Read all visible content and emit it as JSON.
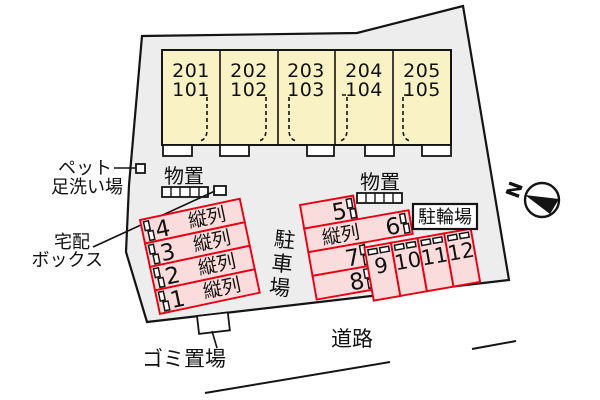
{
  "site": {
    "building": {
      "units": [
        {
          "label_top": "201",
          "label_bottom": "101"
        },
        {
          "label_top": "202",
          "label_bottom": "102"
        },
        {
          "label_top": "203",
          "label_bottom": "103"
        },
        {
          "label_top": "204",
          "label_bottom": "104"
        },
        {
          "label_top": "205",
          "label_bottom": "105"
        }
      ]
    },
    "labels": {
      "storage_left": "物置",
      "storage_right": "物置",
      "pet_wash_line1": "ペット",
      "pet_wash_line2": "足洗い場",
      "delivery_line1": "宅配",
      "delivery_line2": "ボックス",
      "garbage": "ゴミ置場",
      "road": "道路",
      "parking_lot_vertical": "駐車場",
      "bicycle_parking": "駐輪場",
      "north": "N"
    },
    "parking": {
      "left_rows": [
        {
          "number": "4",
          "type": "縦列"
        },
        {
          "number": "3",
          "type": "縦列"
        },
        {
          "number": "2",
          "type": "縦列"
        },
        {
          "number": "1",
          "type": "縦列"
        }
      ],
      "right": {
        "space5": "5",
        "space6": "6",
        "space7": "7",
        "space8": "8",
        "tandem_label": "縦列",
        "vertical_spaces": [
          "9",
          "10",
          "11",
          "12"
        ]
      }
    },
    "colors": {
      "site_fill": "#ededed",
      "building_fill": "#f8f2c4",
      "parking_fill": "#fadcdc",
      "parking_stroke": "#e60012",
      "line": "#141414"
    }
  }
}
